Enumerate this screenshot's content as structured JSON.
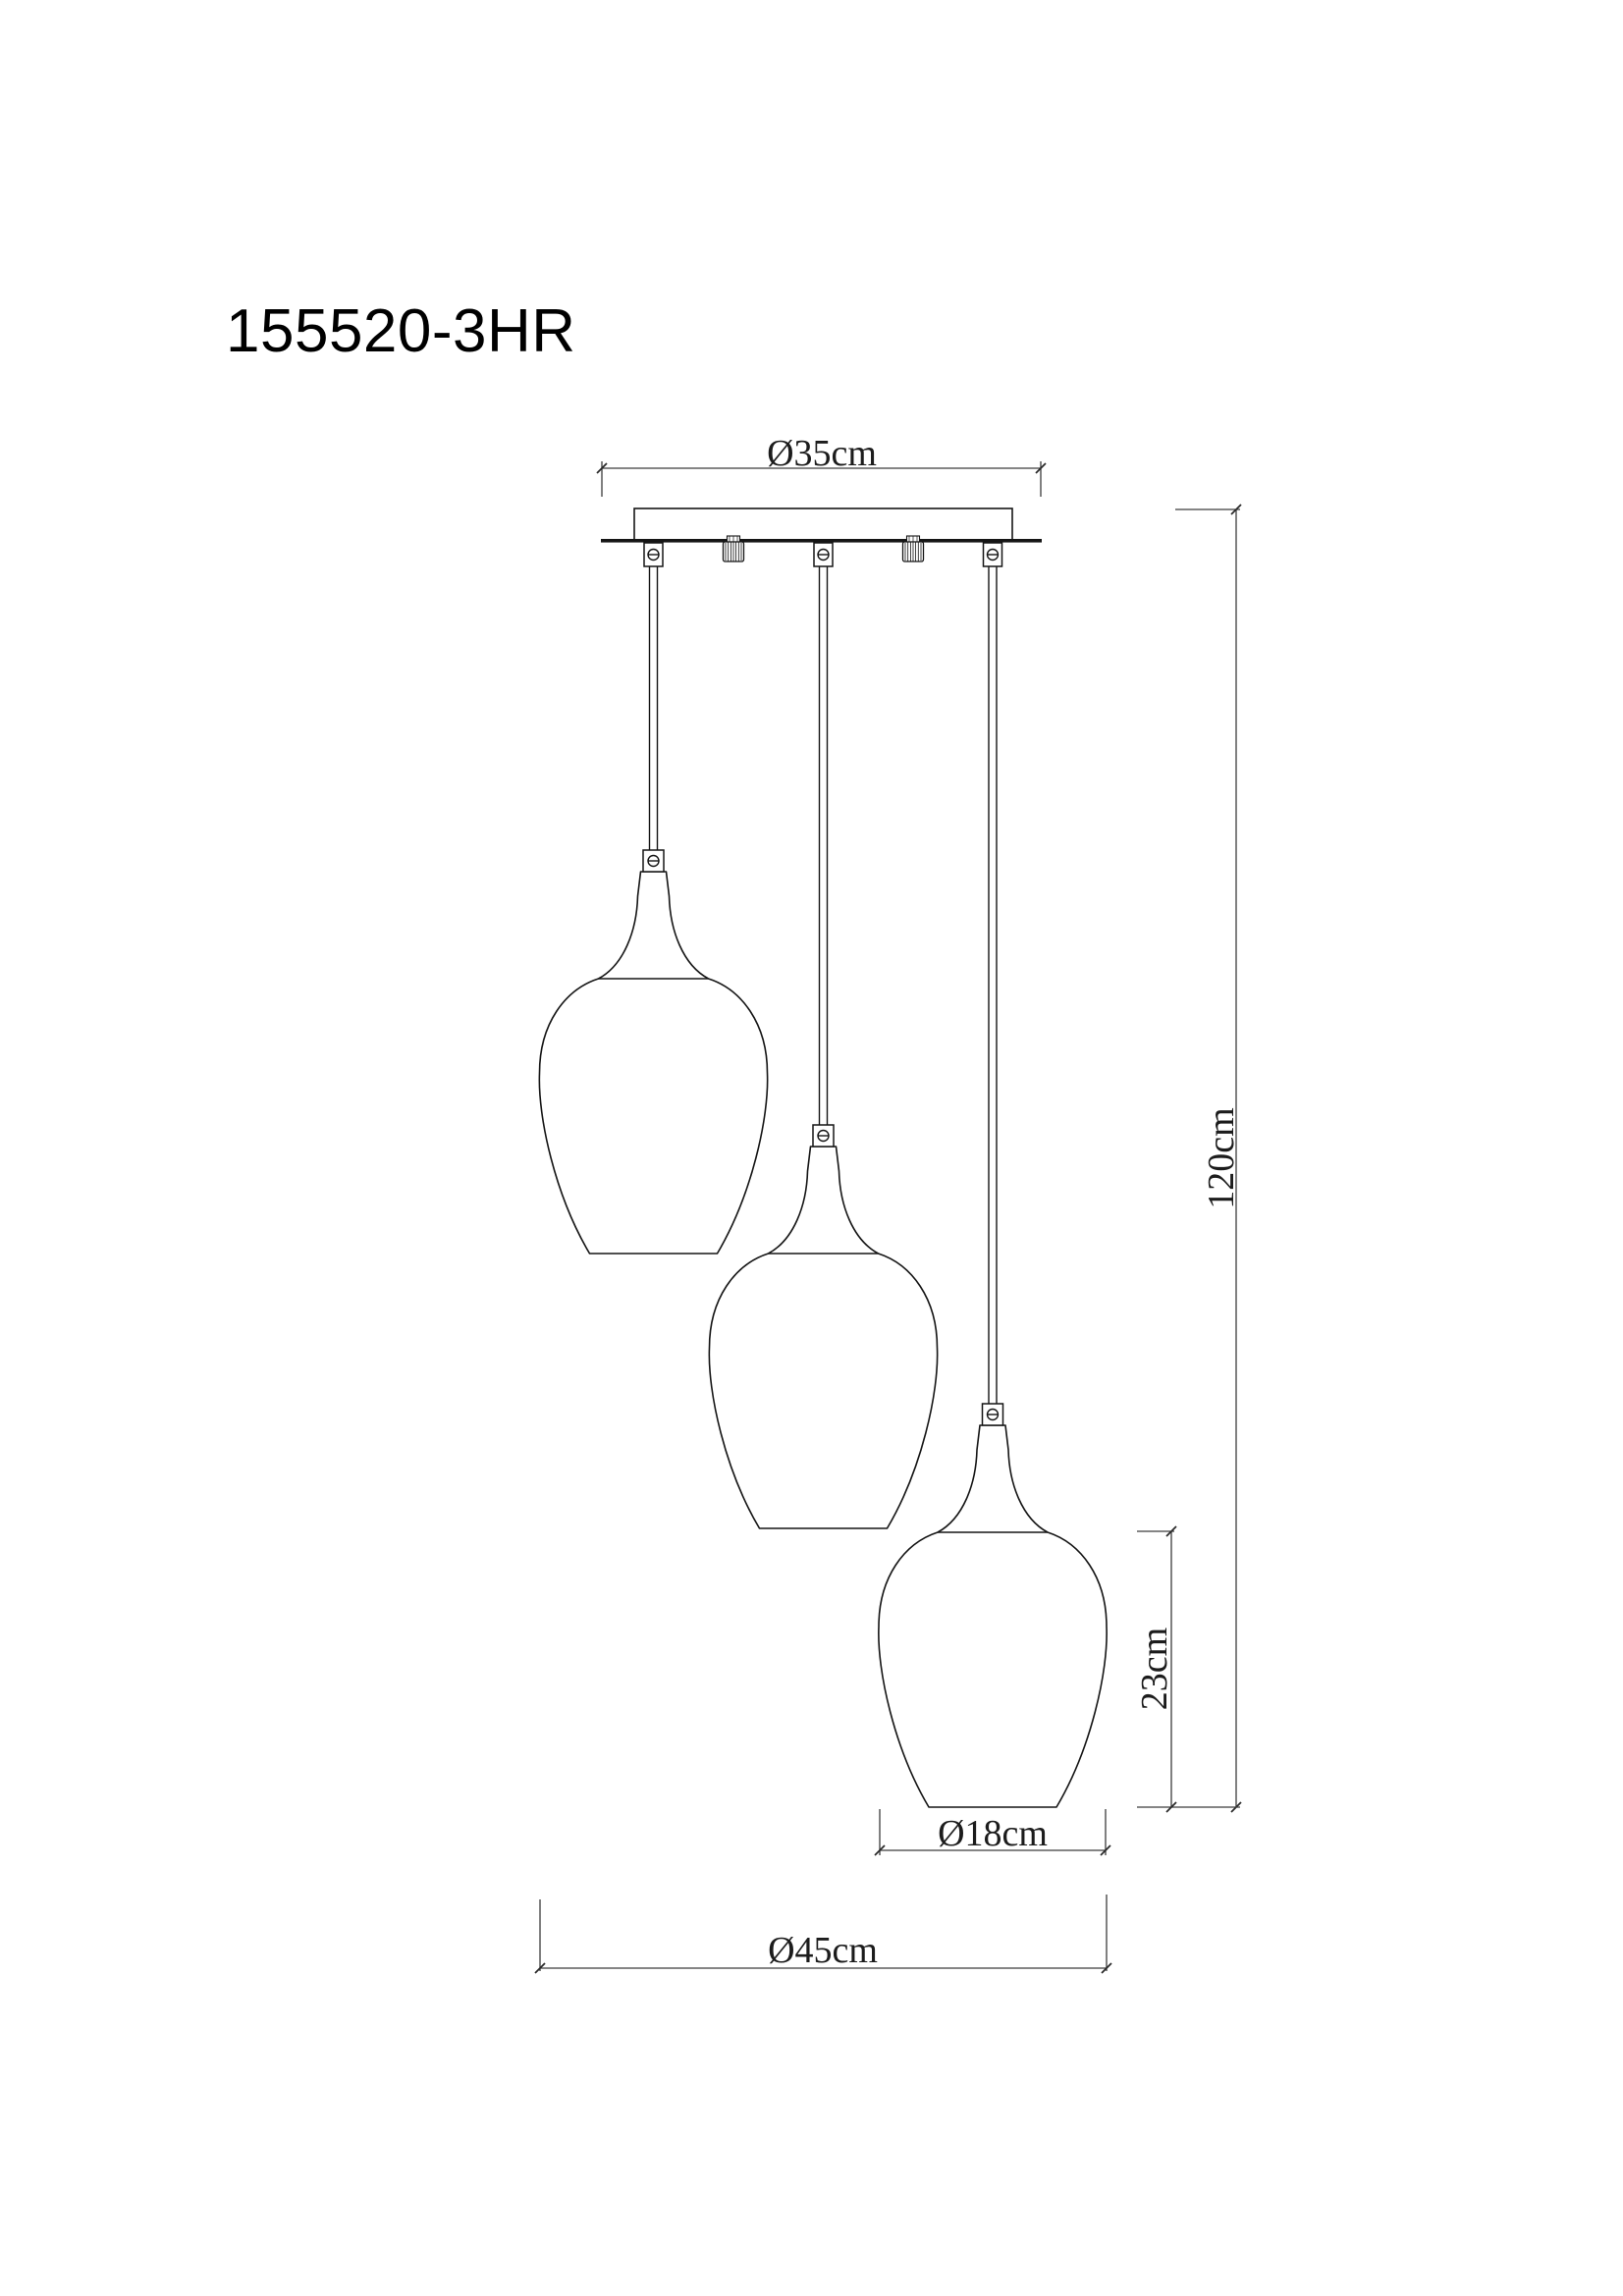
{
  "drawing": {
    "product_code": "155520-3HR",
    "shade_count": 3,
    "dimensions": {
      "canopy_diameter": "Ø35cm",
      "overall_height": "120cm",
      "shade_height": "23cm",
      "shade_diameter": "Ø18cm",
      "fixture_diameter": "Ø45cm"
    },
    "colors": {
      "background": "#ffffff",
      "object_line": "#151515",
      "dimension_line": "#3c3c3c",
      "text": "#000000"
    }
  }
}
